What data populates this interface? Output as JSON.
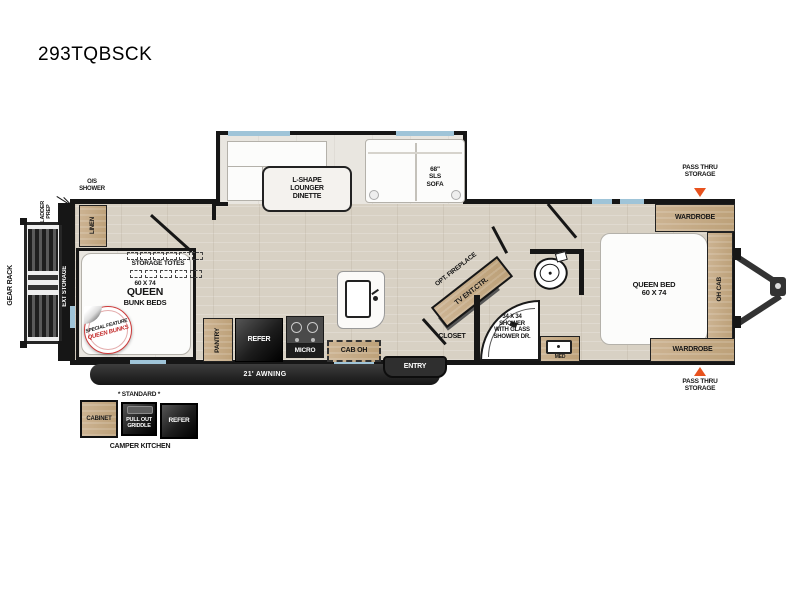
{
  "title": "293TQBSCK",
  "exterior": {
    "gear_rack": "GEAR RACK",
    "ladder_prep": "LADDER\nPREP",
    "os_shower": "O/S\nSHOWER",
    "ext_storage": "EXT STORAGE",
    "pass_thru_top": "PASS THRU\nSTORAGE",
    "pass_thru_bottom": "PASS THRU\nSTORAGE",
    "awning": "21' AWNING",
    "entry": "ENTRY"
  },
  "slideout": {
    "dinette": "L-SHAPE\nLOUNGER\nDINETTE",
    "sofa": "68\"\nSLS\nSOFA"
  },
  "bunk_room": {
    "linen": "LINEN",
    "storage_totes": "STORAGE TOTES",
    "size": "60 X 74",
    "name": "QUEEN",
    "type": "BUNK BEDS",
    "badge_top": "SPECIAL FEATURE",
    "badge_bottom": "QUEEN BUNKS"
  },
  "kitchen": {
    "pantry": "PANTRY",
    "refer": "REFER",
    "micro": "MICRO",
    "cab_oh": "CAB OH"
  },
  "living": {
    "fireplace": "OPT. FIREPLACE",
    "tv": "TV ENT.CTR."
  },
  "bathroom": {
    "closet": "CLOSET",
    "shower": "34 X 34\nSHOWER\nWITH GLASS\nSHOWER DR.",
    "med": "MED"
  },
  "bedroom": {
    "wardrobe_top": "WARDROBE",
    "bed": "QUEEN BED\n60 X 74",
    "oh_cab": "OH CAB",
    "wardrobe_bottom": "WARDROBE"
  },
  "camper_kitchen": {
    "standard": "* STANDARD *",
    "cabinet": "CABINET",
    "griddle": "PULL OUT\nGRIDDLE",
    "refer": "REFER",
    "label": "CAMPER KITCHEN"
  },
  "colors": {
    "accent_orange": "#e8521e",
    "wall": "#161616",
    "wood": "#c7ae8c",
    "window_blue": "#9fc4d8"
  }
}
